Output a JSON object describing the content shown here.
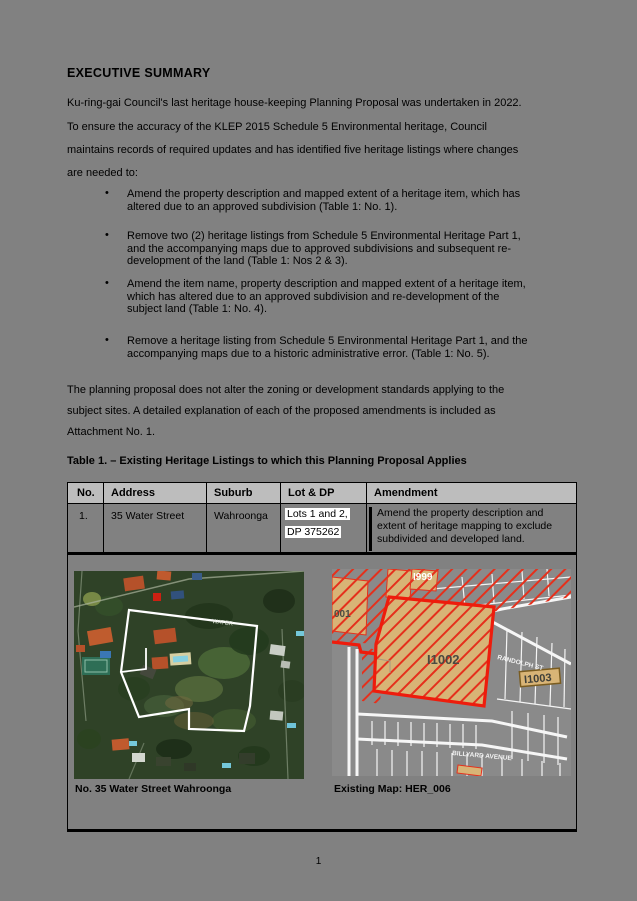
{
  "doc": {
    "heading": "EXECUTIVE SUMMARY",
    "para1_lines": [
      "Ku-ring-gai Council's last heritage house-keeping Planning Proposal was undertaken in 2022.",
      "To ensure the accuracy of the KLEP 2015 Schedule 5 Environmental heritage, Council",
      "maintains records of required updates and has identified five heritage listings where changes",
      "are needed to:"
    ],
    "bullets": [
      {
        "marker": "•",
        "lines": [
          "Amend the property description and mapped extent of a heritage item, which has",
          "altered due to an approved subdivision (Table 1: No. 1)."
        ]
      },
      {
        "marker": "•",
        "lines": [
          "Remove two (2) heritage listings from Schedule 5 Environmental Heritage Part 1,",
          "and the accompanying maps due to approved subdivisions and subsequent re-",
          "development of the land (Table 1: Nos 2 & 3)."
        ]
      },
      {
        "marker": "•",
        "lines": [
          "Amend the item name, property description and mapped extent of a heritage item,",
          "which has altered due to an approved subdivision and re-development of the",
          "subject land (Table 1: No. 4)."
        ]
      },
      {
        "marker": "•",
        "lines": [
          "Remove a heritage listing from Schedule 5 Environmental Heritage Part 1, and the",
          "accompanying maps due to a historic administrative error. (Table 1: No. 5)."
        ]
      }
    ],
    "para2_lines": [
      "The planning proposal does not alter the zoning or development standards applying to the",
      "subject sites. A detailed explanation of each of the proposed amendments is included as",
      "Attachment No. 1."
    ],
    "page_number": "1"
  },
  "table": {
    "title": "Table 1. – Existing Heritage Listings to which this Planning Proposal Applies",
    "headers": [
      "No.",
      "Address",
      "Suburb",
      "Lot & DP",
      "Amendment"
    ],
    "rows": [
      {
        "no": "1.",
        "address": "35 Water Street",
        "suburb": "Wahroonga",
        "lot_dp": [
          "Lots 1 and 2,",
          "DP 375262"
        ],
        "amendment": "Amend the property description and extent of heritage mapping to exclude subdivided and developed land."
      }
    ],
    "captions": {
      "aerial": "No. 35 Water Street Wahroonga",
      "map": "Existing Map: HER_006"
    }
  },
  "aerial": {
    "street_label": "WATER"
  },
  "map": {
    "labels": {
      "item_top": "I999",
      "item_left": "001",
      "item_main": "I1002",
      "item_right": "I1003",
      "street_right": "RANDOLPH ST",
      "street_bottom": "BILLYARD AVENUE"
    }
  },
  "colors": {
    "page_bg": "#818181",
    "table_header_bg": "#bdbdbd",
    "highlight": "#ffffff",
    "heritage_red": "#e5301c",
    "heritage_tan": "#d8b476"
  }
}
